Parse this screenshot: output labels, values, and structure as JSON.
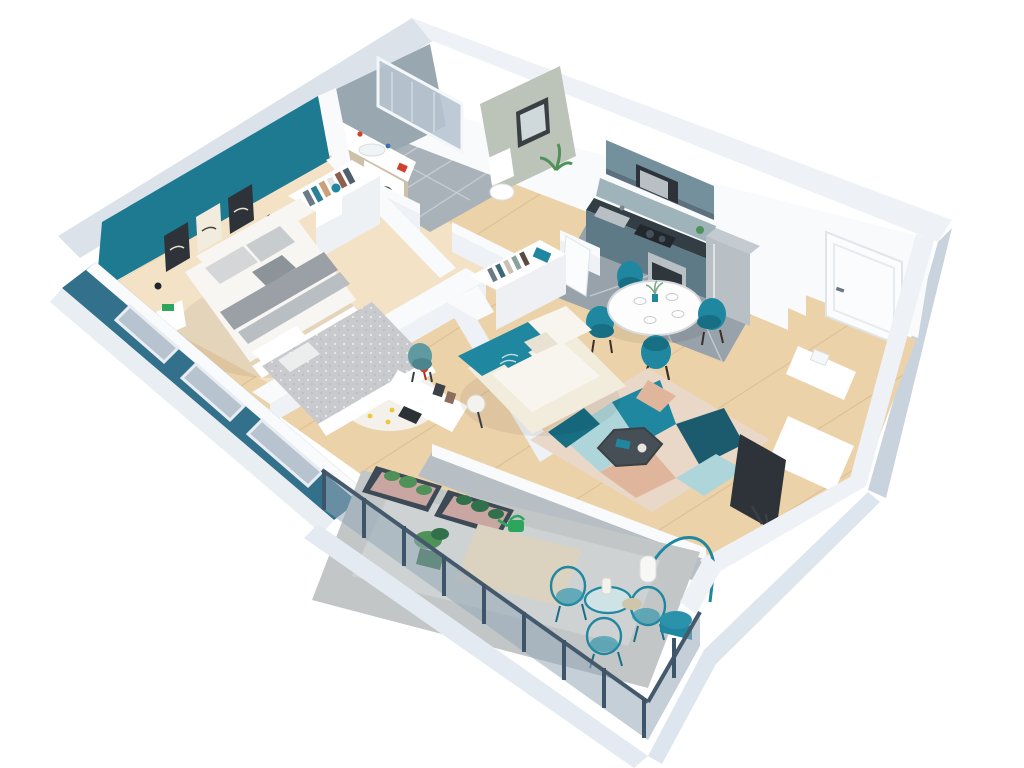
{
  "scene": {
    "kind": "isometric-3d-floor-plan-render",
    "background": "white",
    "rooms": [
      {
        "id": "master-bedroom",
        "items": [
          "teal-accent-wall",
          "wall-art-triptych",
          "double-bed",
          "headboard",
          "foot-bench",
          "nightstand",
          "bedside-lamp",
          "open-wardrobe",
          "window-wall"
        ]
      },
      {
        "id": "bathroom",
        "items": [
          "walk-in-shower",
          "glass-screen",
          "vanity-sink",
          "washing-machine",
          "tiled-floor"
        ]
      },
      {
        "id": "wc",
        "items": [
          "toilet",
          "mirror",
          "plant"
        ]
      },
      {
        "id": "hallway",
        "items": [
          "open-closet",
          "door-leaf",
          "wood-floor"
        ]
      },
      {
        "id": "kitchen",
        "items": [
          "upper-cabinets",
          "microwave",
          "counter",
          "sink",
          "hob",
          "oven",
          "fridge",
          "tall-cabinet",
          "tiled-floor"
        ]
      },
      {
        "id": "dining-area",
        "items": [
          "round-table",
          "tub-chair",
          "tub-chair",
          "tub-chair",
          "tub-chair",
          "tableware",
          "vase"
        ]
      },
      {
        "id": "entrance",
        "items": [
          "entrance-door",
          "door-handle"
        ]
      },
      {
        "id": "living-room",
        "items": [
          "corner-sofa",
          "throw-pillows",
          "ball-floor-lamp",
          "hexagon-coffee-table",
          "geometric-area-rug",
          "tv",
          "tv-bench",
          "side-console"
        ]
      },
      {
        "id": "second-bedroom",
        "items": [
          "low-bed",
          "speckled-duvet",
          "dotted-round-rug",
          "desk",
          "desk-chair",
          "red-desk-lamp",
          "picture-frames",
          "window-wall"
        ]
      },
      {
        "id": "balcony",
        "items": [
          "metal-railing",
          "planter-box",
          "planter-box",
          "potted-plant",
          "watering-can",
          "outdoor-rug",
          "bistro-table",
          "wire-chair",
          "wire-chair",
          "arc-floor-lamp",
          "drum-side-table"
        ]
      }
    ]
  },
  "palette": {
    "bg": "#ffffff",
    "wallBright": "#f8fafb",
    "wallFace": "#eef1f5",
    "wallShade": "#dce2e9",
    "wallEdge": "#c9d3dd",
    "outerBlue": "#b9c9d6",
    "tealWall": "#1e7a91",
    "tealExterior": "#32708c",
    "tealFurn": "#1f87a0",
    "tealDeep": "#186e83",
    "woodMain": "#ecd2a9",
    "woodLight": "#f3e2c6",
    "woodLine": "#d8b98f",
    "tileKitchen": "#98a2aa",
    "tileBath": "#a9b2b8",
    "grout": "#c9d0d5",
    "concrete": "#c3c6c7",
    "matBeige": "#dbd2bf",
    "sofaCream": "#f2ecdd",
    "cushionWhite": "#f8f5ee",
    "rugBase": "#e9d8c7",
    "rugBlush": "#dfb69c",
    "rugTealLight": "#aed6da",
    "rugNavy": "#1c5a6d",
    "duvetGray": "#c8cacd",
    "blanketGray": "#9aa0a5",
    "bedWhite": "#f7f6f2",
    "charcoal": "#2d3338",
    "graphite": "#474f56",
    "applianceSteel": "#b9c0c5",
    "cabinetUpper": "#74909c",
    "cabinetLower": "#5f7a87",
    "counterDark": "#333d44",
    "doorWhite": "#fbfcfd",
    "glass": "#b7c4d0",
    "green": "#4f9159",
    "greenDark": "#31704a",
    "brightGreen": "#2ea55d",
    "red": "#d2402f",
    "yellow": "#eec63d",
    "sage": "#5f9aa0",
    "railPanel": "#93a8b6",
    "railPost": "#3e5468"
  }
}
